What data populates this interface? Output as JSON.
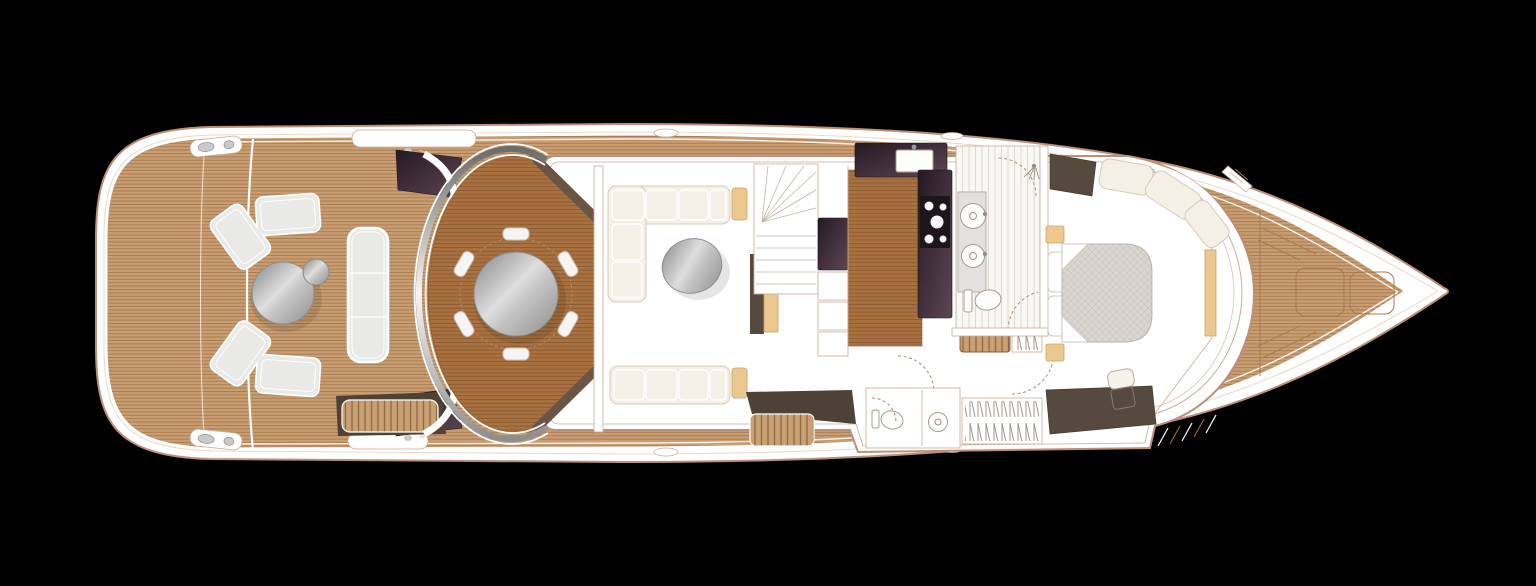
{
  "image": {
    "type": "Yacht main deck floor plan, top-down view, bow facing right",
    "width": 1536,
    "height": 586,
    "background": "#000000"
  },
  "palette": {
    "background": "#000000",
    "hull_outline": "#bb8f79",
    "hull_inner_line": "#e8d8ca",
    "white": "#ffffff",
    "teak": "#c89d72",
    "teak_line": "#a87a4e",
    "wood": "#a9713f",
    "wood_line": "#8a5a31",
    "floor_cream": "#e9dccd",
    "plank_white": "#f8f7f4",
    "plank_line": "#ded9d0",
    "sofa": "#f5f0e6",
    "sofa_edge": "#d6cbb8",
    "cushion_grey": "#e9e9e7",
    "tan": "#eac88f",
    "tan_edge": "#c9a267",
    "dark_wood": "#564a3e",
    "dark_base": "#4e4136",
    "aubergine_dark": "#241a23",
    "aubergine_light": "#5e4554",
    "metal_dark": "#8a8a8a",
    "metal_light": "#dcdcdc",
    "fixture_grey": "#c9c9c9",
    "line": "#b9a18d",
    "wall_edge": "#c9ab97",
    "dash": "#b2886f",
    "quilt": "#dad6cf",
    "quilt_line": "#c8c4bd"
  },
  "vessel": {
    "orientation": "bow-right",
    "areas": [
      {
        "name": "swim-platform",
        "features": [
          "teak decking",
          "transom seams"
        ]
      },
      {
        "name": "aft-cockpit",
        "features": [
          "c-shaped-sofa",
          "round-table",
          "stool",
          "bench-seat-3-cushion",
          "flybridge-steps",
          "mooring-cleats",
          "glazing-panels"
        ]
      },
      {
        "name": "alfresco-dining",
        "features": [
          "circular-teak-platform",
          "chrome-screen-arc",
          "round-dining-table",
          "dining-chairs x6"
        ]
      },
      {
        "name": "saloon",
        "features": [
          "l-shaped-sofa",
          "straight-sofa",
          "end-tables x2",
          "round-coffee-table",
          "sideboard",
          "staircase-up-with-winders",
          "tall-cabinet",
          "lockers"
        ]
      },
      {
        "name": "galley",
        "features": [
          "sink",
          "hob-5-burner",
          "l-shaped-worktop",
          "wood-sole",
          "companionway-stairs-down",
          "hanging-locker"
        ]
      },
      {
        "name": "shower-room",
        "features": [
          "twin-basins",
          "vanity-counter",
          "shower",
          "toilet",
          "plank-sole"
        ]
      },
      {
        "name": "day-head",
        "features": [
          "toilet",
          "round-basin"
        ]
      },
      {
        "name": "master-cabin",
        "features": [
          "double-bed",
          "pillows x2",
          "bedside-tables x2",
          "quilted-mattress",
          "chaise-seat",
          "dresser",
          "vanity-desk",
          "stool",
          "wardrobe"
        ]
      },
      {
        "name": "foredeck",
        "features": [
          "deck-hatches x2",
          "anchor-line-chevrons",
          "teak-decking"
        ]
      },
      {
        "name": "side-decks",
        "features": [
          "port-walkway",
          "starboard-walkway",
          "steps",
          "cleats"
        ]
      }
    ],
    "counts": {
      "dining_chairs": 6,
      "hob_burners": 5,
      "basins": 2,
      "pillows": 2,
      "foredeck_hatches": 2
    }
  }
}
